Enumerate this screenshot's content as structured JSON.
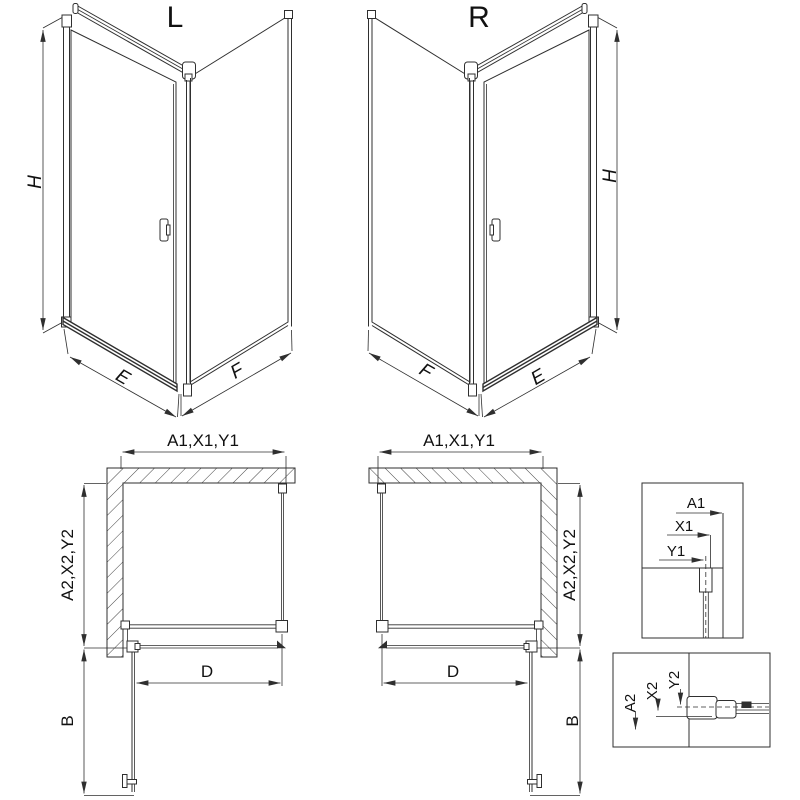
{
  "diagram": {
    "colors": {
      "line": "#2f2f2f",
      "text": "#111111",
      "background": "#ffffff"
    },
    "iso_left": {
      "label": "L",
      "height_dim": "H",
      "door_dim": "E",
      "panel_dim": "F"
    },
    "iso_right": {
      "label": "R",
      "height_dim": "H",
      "door_dim": "E",
      "panel_dim": "F"
    },
    "plan_left": {
      "width_dim": "A1,X1,Y1",
      "depth_dim": "A2,X2,Y2",
      "clear_width_dim": "D",
      "door_open_dim": "B"
    },
    "plan_right": {
      "width_dim": "A1,X1,Y1",
      "depth_dim": "A2,X2,Y2",
      "clear_width_dim": "D",
      "door_open_dim": "B"
    },
    "detail_top": {
      "dim_a1": "A1",
      "dim_x1": "X1",
      "dim_y1": "Y1"
    },
    "detail_bottom": {
      "dim_a2": "A2",
      "dim_x2": "X2",
      "dim_y2": "Y2"
    }
  }
}
